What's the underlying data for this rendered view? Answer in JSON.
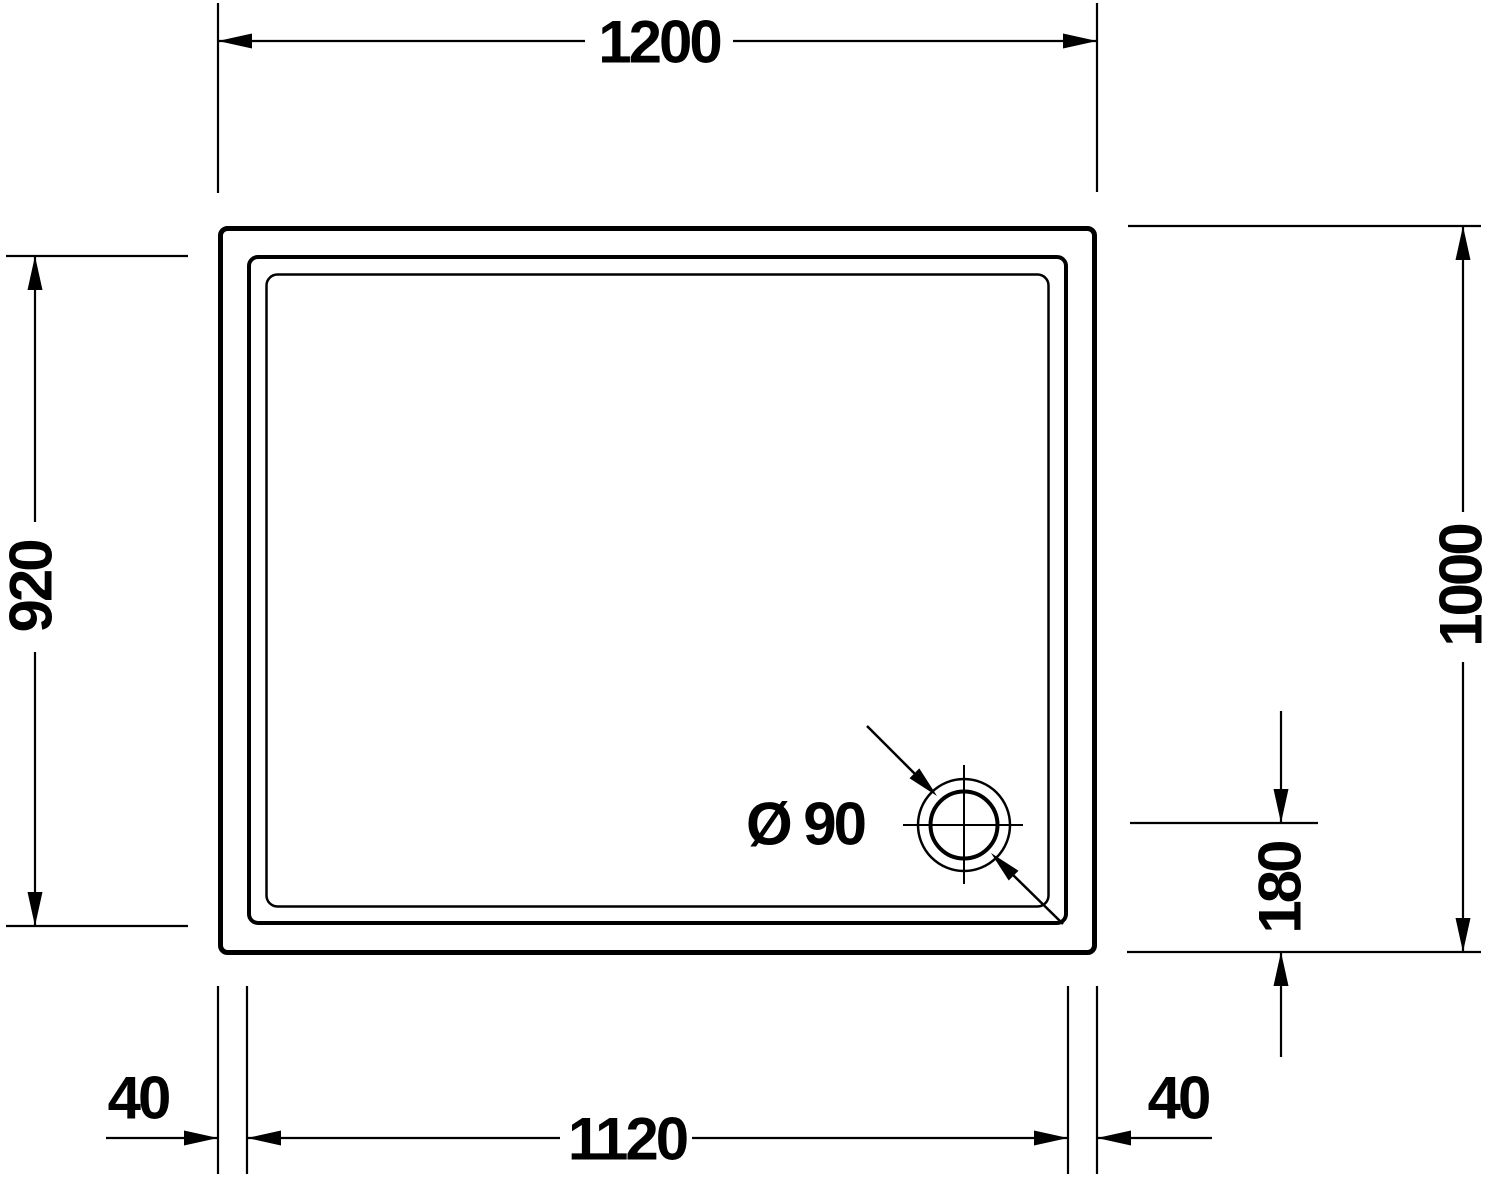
{
  "drawing": {
    "kind": "technical-dimension-drawing",
    "view": "shower-tray-top-view",
    "colors": {
      "ink": "#000000",
      "background": "#ffffff"
    }
  },
  "labels": {
    "overall_width": "1200",
    "inner_depth": "920",
    "overall_depth": "1000",
    "drain_to_edge": "180",
    "inner_width": "1120",
    "left_wall": "40",
    "right_wall": "40",
    "drain_diameter": "Ø 90"
  }
}
